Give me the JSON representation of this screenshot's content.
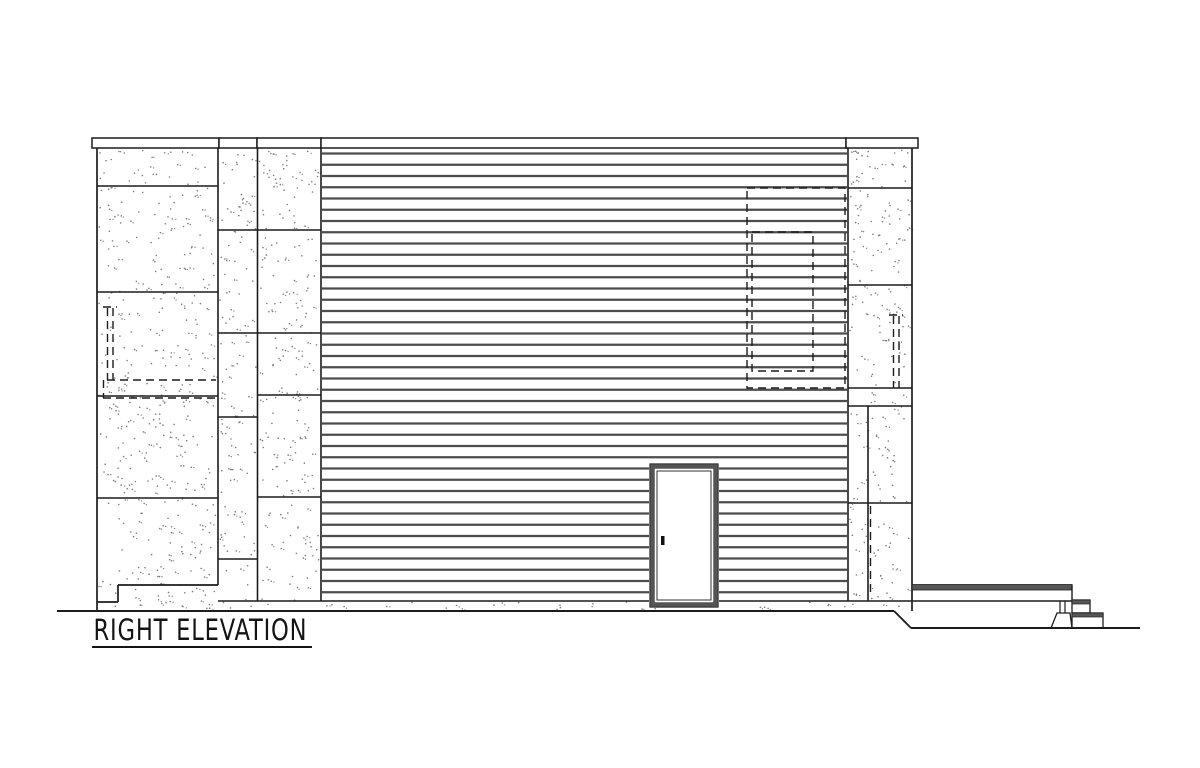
{
  "title": {
    "text": "RIGHT ELEVATION"
  },
  "drawing": {
    "width": 1200,
    "height": 768,
    "colors": {
      "bg": "#ffffff",
      "ink": "#1c1c1c",
      "siding_line": "#4d4d4d",
      "band_fill": "#565656",
      "door_frame": "#545454",
      "stipple": "#7c7c7c"
    },
    "cap": {
      "y": 138,
      "height": 10,
      "segments": [
        [
          92,
          219
        ],
        [
          219,
          257
        ],
        [
          257,
          321
        ],
        [
          321,
          846
        ],
        [
          846,
          918
        ]
      ]
    },
    "walls": {
      "outline": [
        [
          97,
          148,
          97,
          611
        ],
        [
          97,
          602,
          118,
          602
        ],
        [
          118,
          602,
          118,
          585
        ],
        [
          118,
          585,
          218,
          585
        ],
        [
          912,
          148,
          912,
          611
        ]
      ],
      "verticals": [
        [
          218,
          148,
          585
        ],
        [
          257.5,
          148,
          601
        ],
        [
          321,
          148,
          601
        ],
        [
          848,
          148,
          601
        ],
        [
          868,
          406,
          601
        ]
      ],
      "joints": [
        {
          "x1": 97,
          "x2": 218,
          "ys": [
            186,
            292,
            396,
            498
          ]
        },
        {
          "x1": 218,
          "x2": 257.5,
          "ys": [
            230,
            333,
            417,
            559
          ]
        },
        {
          "x1": 257.5,
          "x2": 321,
          "ys": [
            230,
            333,
            395,
            497
          ]
        },
        {
          "x1": 848,
          "x2": 912,
          "ys": [
            188,
            285,
            388,
            406,
            503
          ]
        },
        {
          "x1": 218,
          "x2": 912,
          "ys": [
            601
          ]
        }
      ]
    },
    "siding": {
      "x1": 322,
      "x2": 847,
      "y_first": 153.5,
      "spacing": 11.25,
      "count": 40,
      "stroke_width": 2.2
    },
    "door": {
      "x": 650,
      "y": 464,
      "width": 68,
      "height": 143,
      "frame_inset": 2.5,
      "frame_width": 4.5,
      "handle": {
        "x": 661,
        "y": 536,
        "width": 3.5,
        "height": 9
      }
    },
    "hidden_dashed": {
      "dash": "8 5",
      "rects": [
        [
          747,
          188,
          98,
          200
        ],
        [
          752,
          232,
          61,
          139
        ]
      ],
      "lines": [
        [
          107.5,
          308,
          107.5,
          380
        ],
        [
          113,
          308,
          113,
          380
        ],
        [
          103,
          307,
          117,
          307
        ],
        [
          107,
          380,
          216,
          380
        ],
        [
          103,
          398,
          216,
          398
        ],
        [
          103.5,
          380,
          103.5,
          398
        ],
        [
          893.5,
          316,
          893.5,
          388
        ],
        [
          899,
          316,
          899,
          388
        ],
        [
          889,
          315,
          903,
          315
        ],
        [
          870.5,
          506,
          870.5,
          596
        ]
      ]
    },
    "deck": {
      "band": {
        "x": 912,
        "y": 584.5,
        "width": 160,
        "height": 5.5
      },
      "lines": [
        [
          912,
          601,
          1072,
          601
        ],
        [
          1072,
          584.5,
          1072,
          600
        ]
      ],
      "steps": [
        {
          "x": 1072,
          "y": 600,
          "width": 18,
          "height": 13
        },
        {
          "x": 1072,
          "y": 613,
          "width": 31,
          "height": 15
        }
      ],
      "post_lines": [
        [
          1060,
          601,
          1060,
          613
        ],
        [
          1065,
          601,
          1065,
          613
        ]
      ],
      "footing": [
        [
          1051,
          628
        ],
        [
          1057,
          613
        ],
        [
          1070,
          613
        ],
        [
          1072,
          628
        ]
      ]
    },
    "ground": {
      "segments": [
        [
          57,
          611,
          894,
          611
        ],
        [
          894,
          611,
          911,
          628
        ],
        [
          911,
          628,
          1140,
          628
        ]
      ]
    },
    "stipple": {
      "seed": 7,
      "density": 130,
      "dot_radius": 0.8,
      "regions": [
        [
          99,
          150,
          117,
          459
        ],
        [
          220,
          150,
          36,
          459
        ],
        [
          259,
          150,
          60,
          459
        ],
        [
          850,
          150,
          60,
          459
        ],
        [
          322,
          602,
          525,
          8
        ]
      ]
    }
  }
}
